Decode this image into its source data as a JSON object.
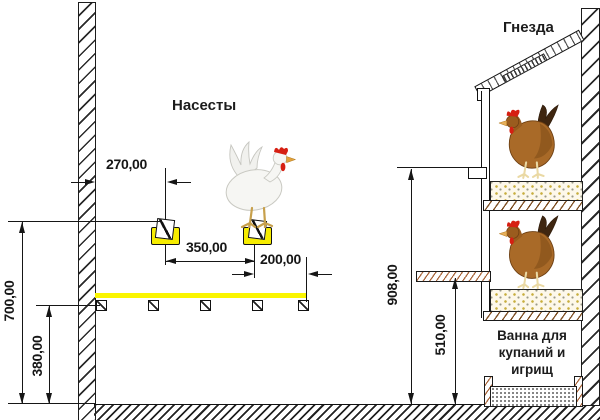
{
  "diagram": {
    "section_labels": {
      "perches": "Насесты",
      "nests": "Гнезда",
      "bath": {
        "line1": "Ванна для",
        "line2": "купаний и",
        "line3": "игрищ"
      }
    },
    "dimensions": {
      "wall_to_first_perch": "270,00",
      "perch_spacing": "350,00",
      "second_perch_to_edge": "200,00",
      "perch_height_total": "700,00",
      "dropping_board_height": "380,00",
      "nest_top_height": "908,00",
      "nest_bottom_height": "510,00"
    },
    "icons": {
      "white_hen": "white-hen-icon",
      "brown_hen_top": "brown-hen-icon",
      "brown_hen_bottom": "brown-hen-icon"
    },
    "colors": {
      "perch_accent": "#faf500",
      "hen_brown": "#a96a28",
      "comb_red": "#d61f12",
      "line_black": "#161616",
      "bedding_bg": "#fdf8ea",
      "bedding_dot": "#c8ae3e"
    }
  }
}
